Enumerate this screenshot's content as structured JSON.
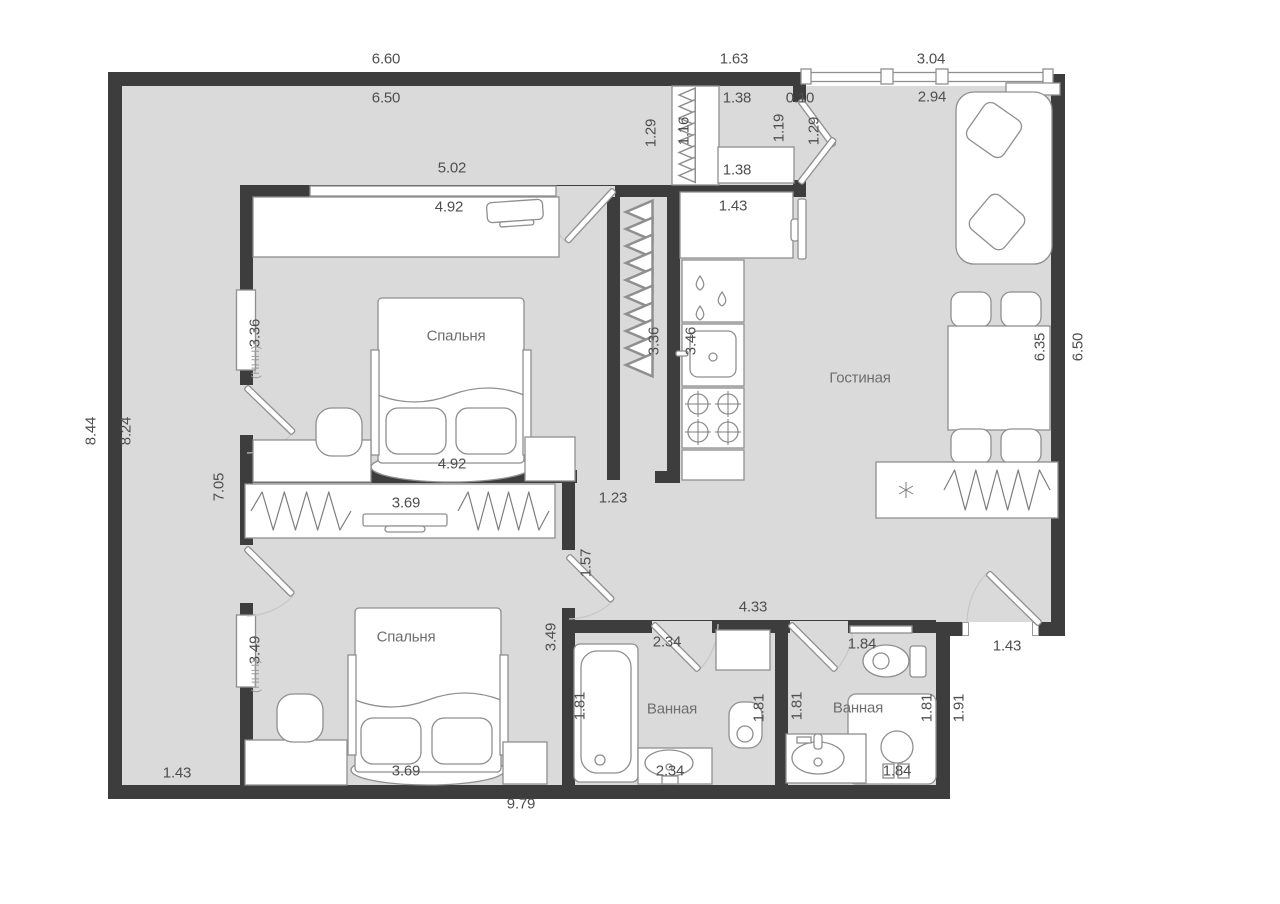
{
  "title": "Floor plan of a two-bedroom apartment (dimensions in meters)",
  "palette": {
    "wall": "#3d3d3d",
    "floor": "#dadada",
    "line": "#8f8f8f",
    "text": "#4f4f4f",
    "room_text": "#6e6e6e",
    "outside": "#ffffff"
  },
  "rooms": [
    {
      "name": "Спальня",
      "x": 456,
      "y": 336
    },
    {
      "name": "Спальня",
      "x": 406,
      "y": 637
    },
    {
      "name": "Гостиная",
      "x": 860,
      "y": 378
    },
    {
      "name": "Ванная",
      "x": 672,
      "y": 709
    },
    {
      "name": "Ванная",
      "x": 858,
      "y": 708
    }
  ],
  "dimensions": [
    {
      "t": "6.60",
      "x": 386,
      "y": 59
    },
    {
      "t": "1.63",
      "x": 734,
      "y": 59
    },
    {
      "t": "3.04",
      "x": 931,
      "y": 59
    },
    {
      "t": "6.50",
      "x": 386,
      "y": 98
    },
    {
      "t": "1.38",
      "x": 737,
      "y": 98
    },
    {
      "t": "0.10",
      "x": 800,
      "y": 98
    },
    {
      "t": "2.94",
      "x": 932,
      "y": 97
    },
    {
      "t": "1.16",
      "x": 684,
      "y": 131,
      "r": 1
    },
    {
      "t": "1.29",
      "x": 651,
      "y": 133,
      "r": 1
    },
    {
      "t": "1.19",
      "x": 779,
      "y": 128,
      "r": 1
    },
    {
      "t": "1.29",
      "x": 814,
      "y": 131,
      "r": 1
    },
    {
      "t": "1.38",
      "x": 737,
      "y": 170
    },
    {
      "t": "1.43",
      "x": 733,
      "y": 206
    },
    {
      "t": "5.02",
      "x": 452,
      "y": 168
    },
    {
      "t": "4.92",
      "x": 449,
      "y": 207
    },
    {
      "t": "8.44",
      "x": 91,
      "y": 431,
      "r": 1
    },
    {
      "t": "8.24",
      "x": 126,
      "y": 431,
      "r": 1
    },
    {
      "t": "3.36",
      "x": 255,
      "y": 333,
      "r": 1
    },
    {
      "t": "3.36",
      "x": 654,
      "y": 341,
      "r": 1
    },
    {
      "t": "3.46",
      "x": 691,
      "y": 341,
      "r": 1
    },
    {
      "t": "6.35",
      "x": 1040,
      "y": 347,
      "r": 1
    },
    {
      "t": "6.50",
      "x": 1078,
      "y": 347,
      "r": 1
    },
    {
      "t": "4.92",
      "x": 452,
      "y": 464
    },
    {
      "t": "7.05",
      "x": 219,
      "y": 487,
      "r": 1
    },
    {
      "t": "1.23",
      "x": 613,
      "y": 498
    },
    {
      "t": "3.69",
      "x": 406,
      "y": 503
    },
    {
      "t": "1.57",
      "x": 586,
      "y": 563,
      "r": 1
    },
    {
      "t": "3.49",
      "x": 255,
      "y": 650,
      "r": 1
    },
    {
      "t": "3.49",
      "x": 551,
      "y": 637,
      "r": 1
    },
    {
      "t": "4.33",
      "x": 753,
      "y": 607
    },
    {
      "t": "2.34",
      "x": 667,
      "y": 642
    },
    {
      "t": "1.84",
      "x": 862,
      "y": 644
    },
    {
      "t": "1.43",
      "x": 1007,
      "y": 646
    },
    {
      "t": "1.81",
      "x": 580,
      "y": 706,
      "r": 1
    },
    {
      "t": "1.81",
      "x": 759,
      "y": 708,
      "r": 1
    },
    {
      "t": "1.81",
      "x": 797,
      "y": 706,
      "r": 1
    },
    {
      "t": "1.81",
      "x": 927,
      "y": 708,
      "r": 1
    },
    {
      "t": "1.91",
      "x": 959,
      "y": 708,
      "r": 1
    },
    {
      "t": "1.43",
      "x": 177,
      "y": 773
    },
    {
      "t": "3.69",
      "x": 406,
      "y": 771
    },
    {
      "t": "2.34",
      "x": 670,
      "y": 771
    },
    {
      "t": "1.84",
      "x": 897,
      "y": 771
    },
    {
      "t": "9.79",
      "x": 521,
      "y": 804
    }
  ],
  "radiator_marks": [
    {
      "t": "(ННН)",
      "x": 256,
      "y": 362,
      "r": 1
    },
    {
      "t": "(ННН)",
      "x": 256,
      "y": 676,
      "r": 1
    }
  ]
}
